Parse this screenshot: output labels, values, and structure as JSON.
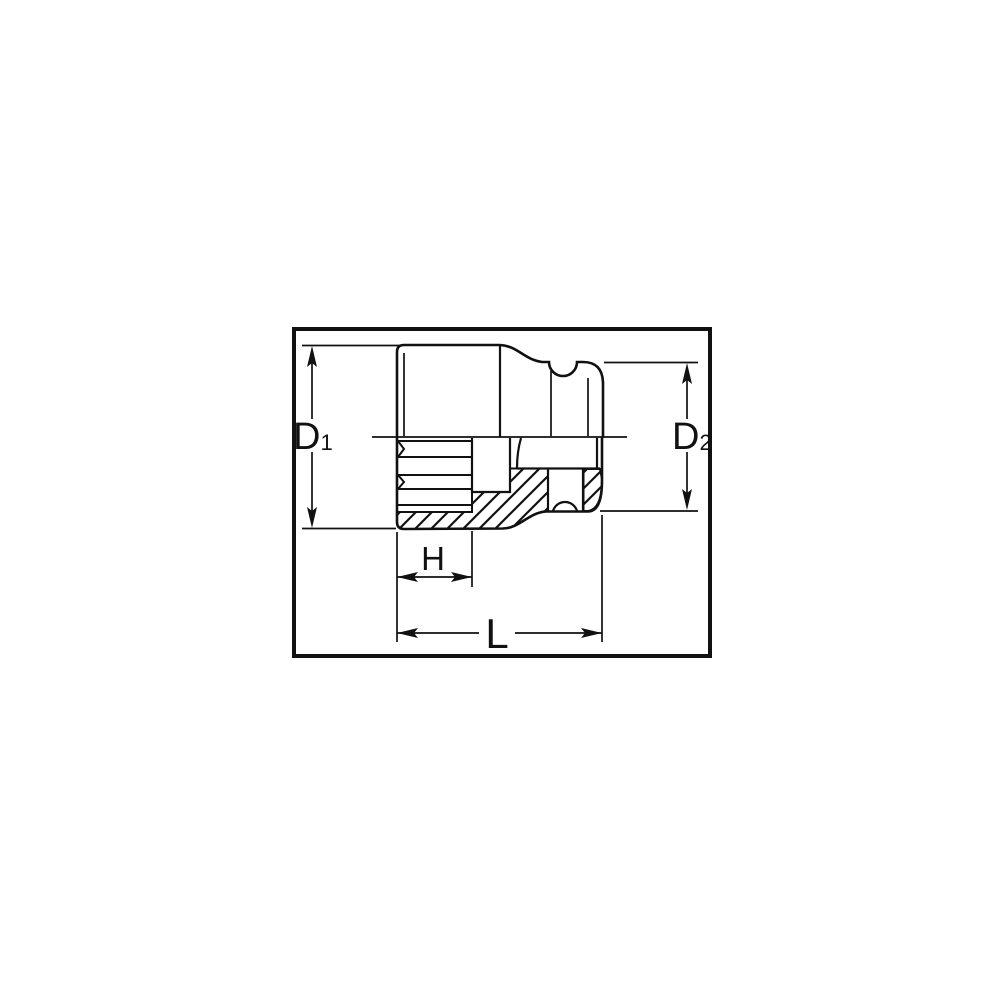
{
  "diagram": {
    "colors": {
      "ink": "#111111",
      "background": "#ffffff"
    },
    "labels": {
      "d1": {
        "main": "D",
        "sub": "1",
        "full": "D₁"
      },
      "d2": {
        "main": "D",
        "sub": "2",
        "full": "D₂"
      },
      "h": {
        "text": "H"
      },
      "l": {
        "text": "L"
      }
    }
  }
}
